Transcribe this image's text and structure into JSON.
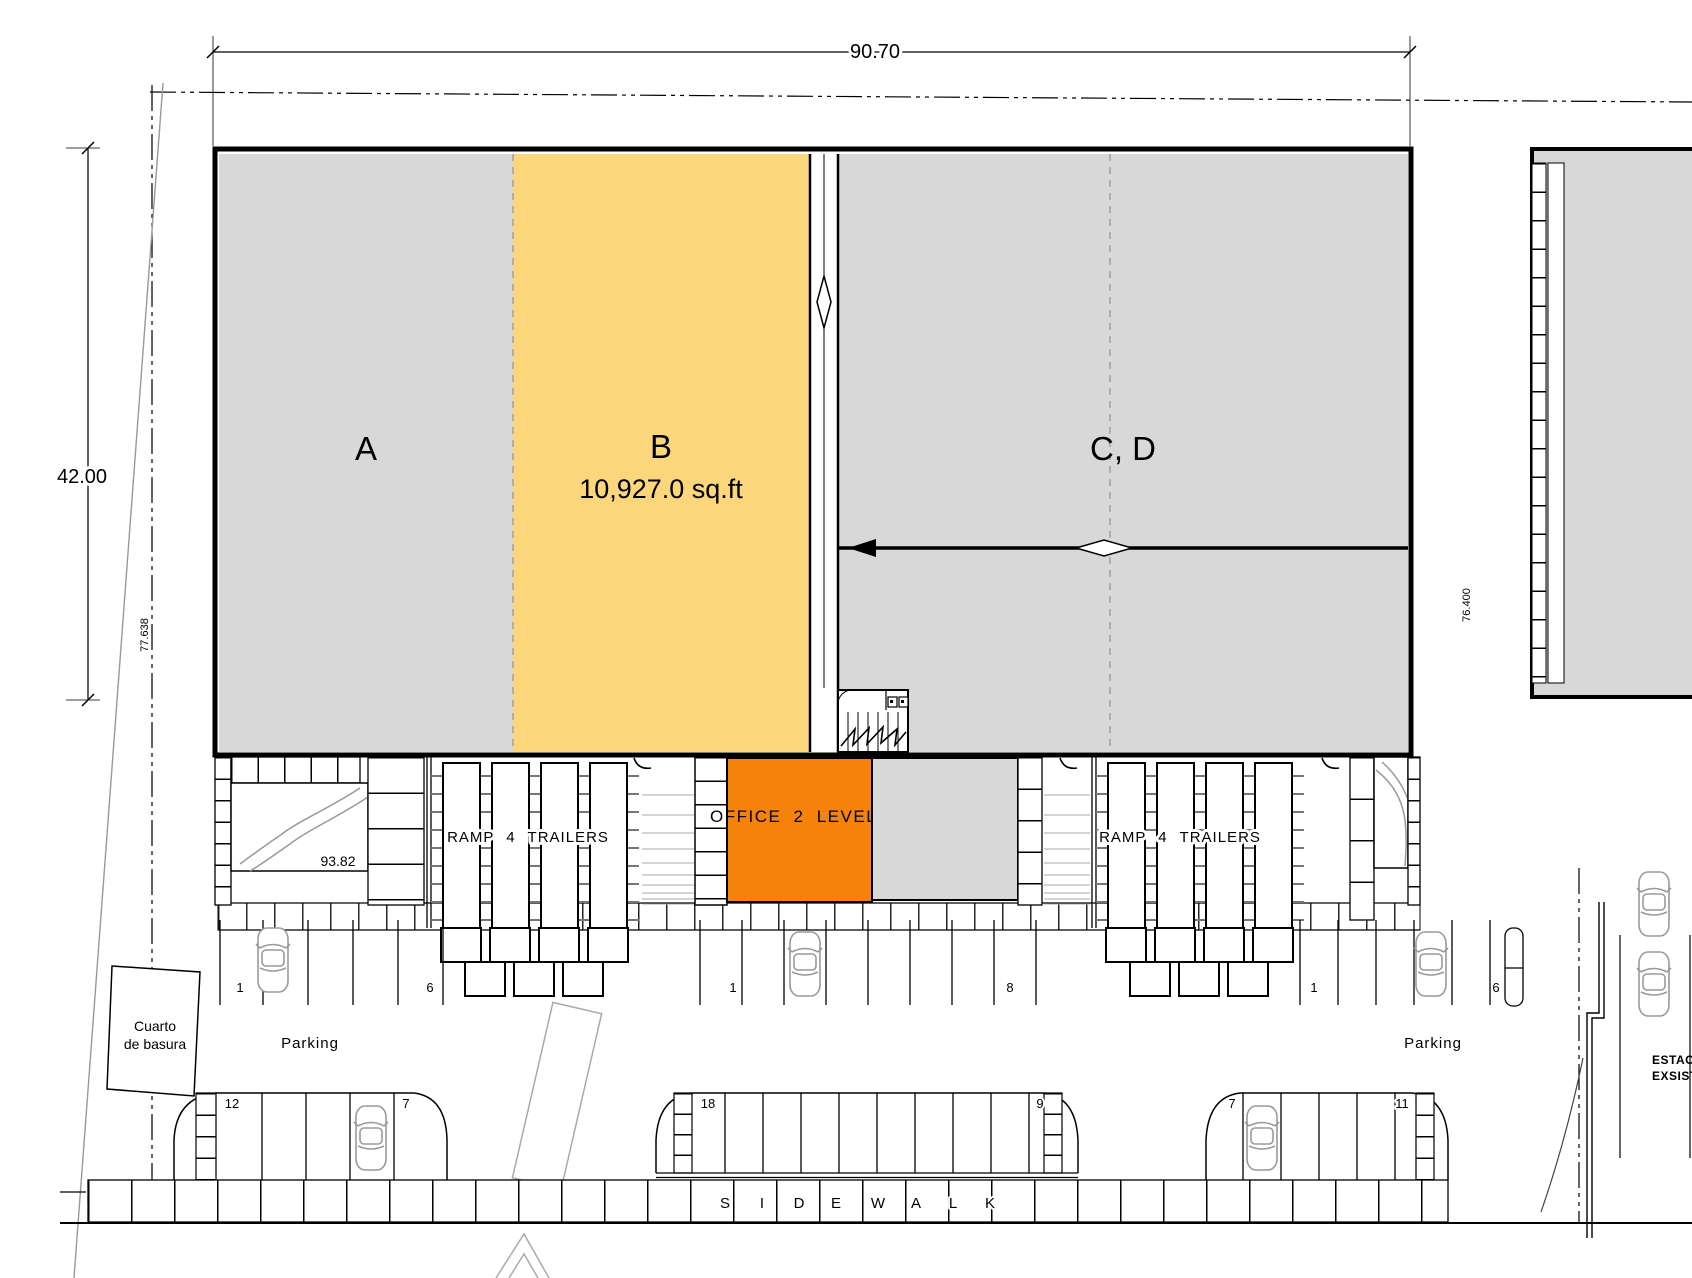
{
  "colors": {
    "unit_fill": "#d8d8d8",
    "unit_b_fill": "#fbd67b",
    "office_fill": "#f7820b",
    "existing_fill": "#d8d8d8"
  },
  "dimensions": {
    "top_width": "90.70",
    "left_height": "42.00",
    "boundary_left": "77.638",
    "boundary_right": "76.400",
    "dock_level": "93.82"
  },
  "units": {
    "a": "A",
    "b": "B",
    "b_area": "10,927.0 sq.ft",
    "cd": "C, D",
    "office": "OFFICE 2 LEVELS"
  },
  "ramps": {
    "left": "RAMP 4 TRAILERS",
    "right": "RAMP 4 TRAILERS"
  },
  "trash_room": {
    "line1": "Cuarto",
    "line2": "de basura"
  },
  "parking": {
    "left_label": "Parking",
    "right_label": "Parking",
    "upper_row": {
      "left_start": "1",
      "left_end": "6",
      "middle_start": "1",
      "middle_end": "8",
      "right_start": "1",
      "right_end": "6"
    },
    "lower_row": {
      "left_start": "12",
      "left_end": "7",
      "middle_start": "18",
      "middle_end": "9",
      "right_start": "7",
      "right_end": "11"
    }
  },
  "sidewalk": {
    "letters": [
      "S",
      "I",
      "D",
      "E",
      "W",
      "A",
      "L",
      "K"
    ]
  },
  "existing_lot": {
    "line1": "ESTACIO",
    "line2": "EXSISTE"
  }
}
